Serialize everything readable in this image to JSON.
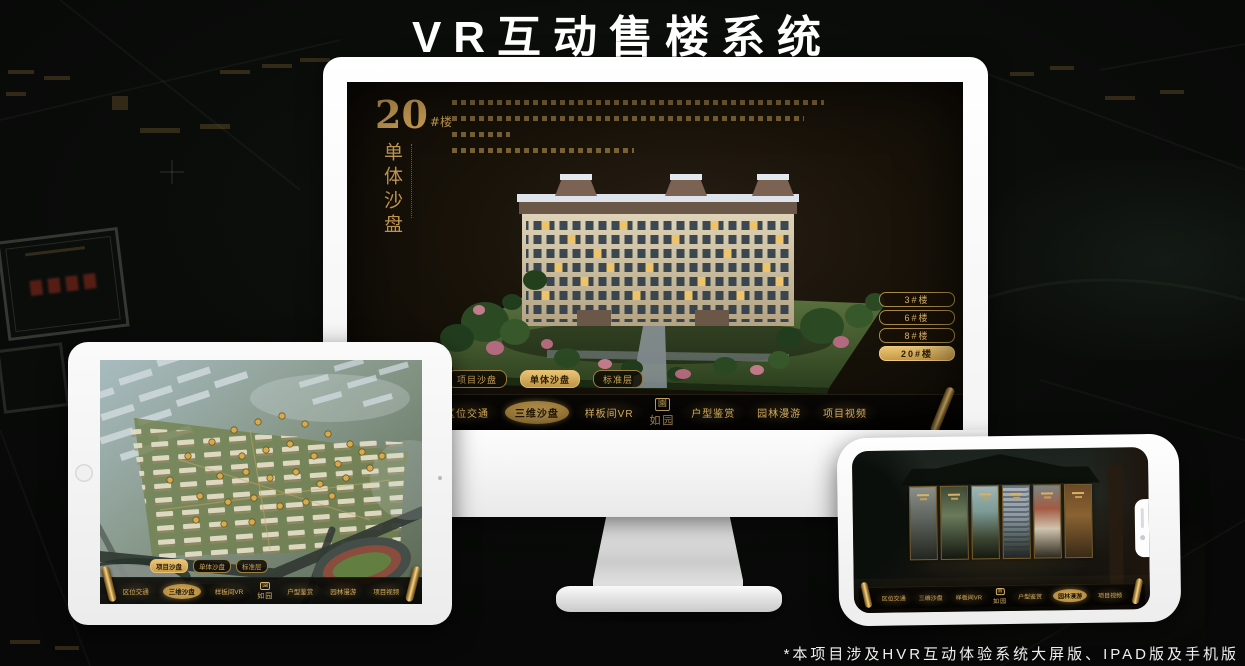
{
  "page": {
    "title": "VR互动售楼系统",
    "footnote": "*本项目涉及HVR互动体验系统大屏版、IPAD版及手机版"
  },
  "logo": {
    "name": "如园",
    "seal": "園"
  },
  "tabs": [
    {
      "label": "项目沙盘"
    },
    {
      "label": "单体沙盘"
    },
    {
      "label": "标准层"
    }
  ],
  "nav": {
    "items": [
      {
        "label": "区位交通"
      },
      {
        "label": "三维沙盘"
      },
      {
        "label": "样板间VR"
      },
      {
        "label": "户型鉴赏"
      },
      {
        "label": "园林漫游"
      },
      {
        "label": "项目视频"
      }
    ]
  },
  "monitor": {
    "building_number": "20",
    "building_unit": "#楼",
    "section_title": "单体沙盘",
    "floors": [
      {
        "label": "3#楼"
      },
      {
        "label": "6#楼"
      },
      {
        "label": "8#楼"
      },
      {
        "label": "20#楼"
      }
    ],
    "selected_floor": "20#楼",
    "selected_tab": "单体沙盘",
    "selected_nav": "三维沙盘"
  },
  "tablet": {
    "selected_tab": "项目沙盘",
    "selected_nav": "三维沙盘"
  },
  "phone": {
    "selected_nav": "园林漫游"
  },
  "colors": {
    "gold": "#c9a050",
    "gold_bright": "#ecc678",
    "screen_dark": "#120d08"
  }
}
